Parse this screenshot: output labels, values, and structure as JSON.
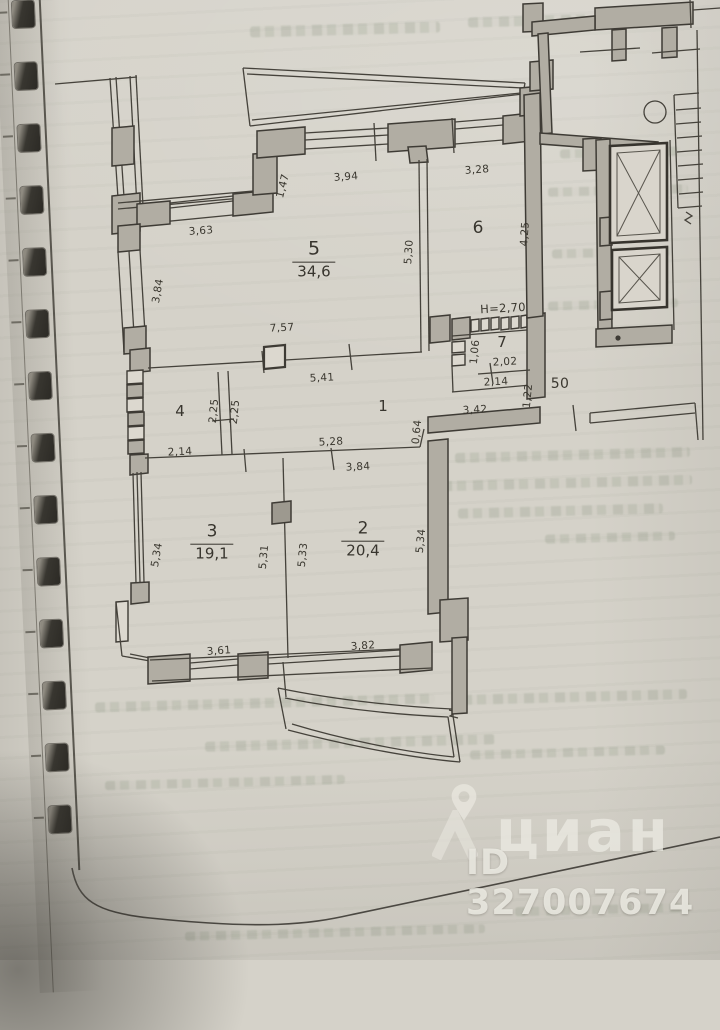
{
  "watermark": {
    "brand": "циан",
    "id": "ID 327007674"
  },
  "rooms": {
    "r5": {
      "num": "5",
      "area": "34,6"
    },
    "r6": {
      "num": "6"
    },
    "r7": {
      "num": "7"
    },
    "r1": {
      "num": "1"
    },
    "r4": {
      "num": "4"
    },
    "r3": {
      "num": "3",
      "area": "19,1"
    },
    "r2": {
      "num": "2",
      "area": "20,4"
    }
  },
  "dims": [
    {
      "text": "3,63"
    },
    {
      "text": "1,47"
    },
    {
      "text": "3,94"
    },
    {
      "text": "3,28"
    },
    {
      "text": "5,30"
    },
    {
      "text": "3,84"
    },
    {
      "text": "7,57"
    },
    {
      "text": "5,41"
    },
    {
      "text": "2,25"
    },
    {
      "text": "2,25"
    },
    {
      "text": "2,14"
    },
    {
      "text": "5,28"
    },
    {
      "text": "3,84"
    },
    {
      "text": "0,64"
    },
    {
      "text": "3,42"
    },
    {
      "text": "1,22"
    },
    {
      "text": "50"
    },
    {
      "text": "Н=2,70"
    },
    {
      "text": "1,06"
    },
    {
      "text": "2,02"
    },
    {
      "text": "2,14"
    },
    {
      "text": "4,25"
    },
    {
      "text": "5,34"
    },
    {
      "text": "5,31"
    },
    {
      "text": "5,33"
    },
    {
      "text": "5,34"
    },
    {
      "text": "3,61"
    },
    {
      "text": "3,82"
    }
  ]
}
